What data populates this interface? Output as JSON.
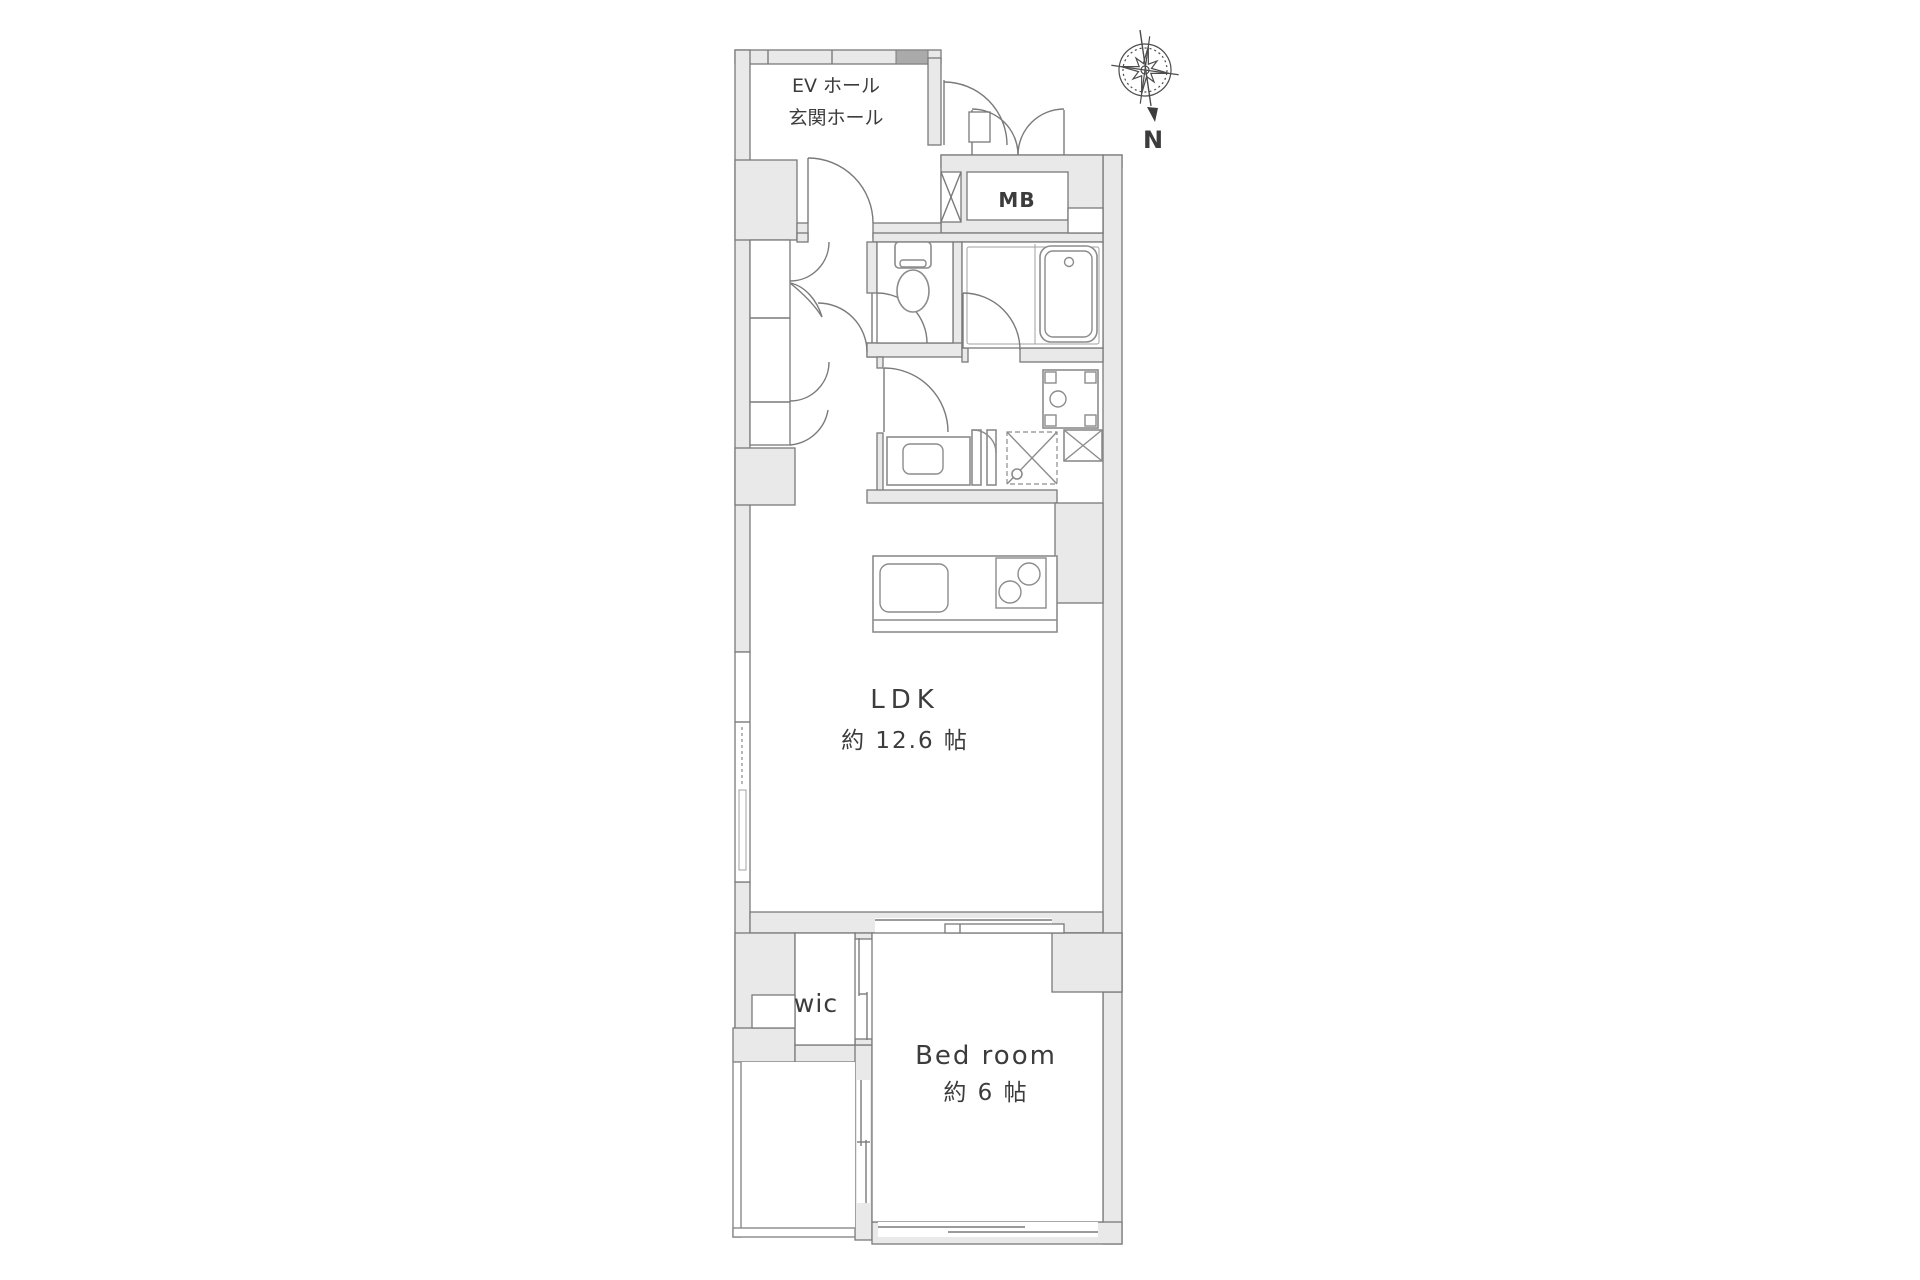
{
  "floor_plan": {
    "compass": {
      "north_label": "N"
    },
    "labels": {
      "ev_hall": "EV ホール",
      "entrance_hall": "玄関ホール",
      "meter_box": "MB"
    },
    "rooms": {
      "ldk": {
        "name": "LDK",
        "area": "約 12.6 帖"
      },
      "bedroom": {
        "name": "Bed room",
        "area": "約 6 帖"
      },
      "walk_in_closet": {
        "name": "wic"
      }
    },
    "colors": {
      "wall_fill": "#e9e9e9",
      "wall_line": "#7a7a7a",
      "text": "#3c3c3c"
    }
  }
}
